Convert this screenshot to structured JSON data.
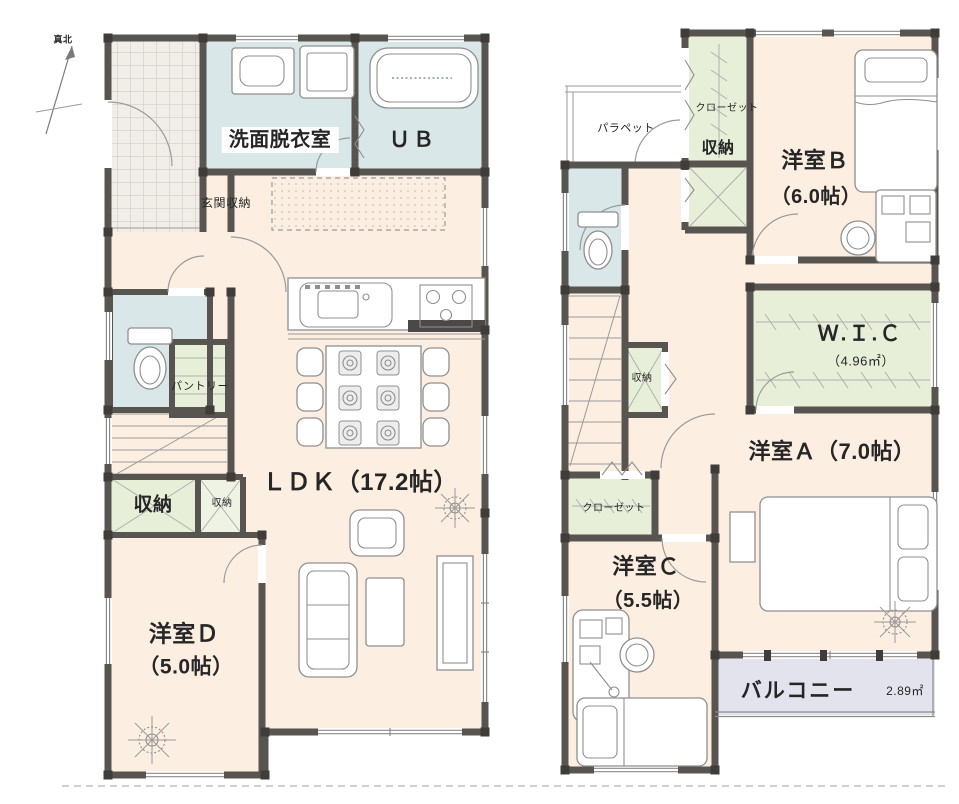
{
  "colors": {
    "wall": "#585450",
    "floor": "#fcefe1",
    "wet": "#d9e7e9",
    "storage": "#e8efd8",
    "tile_area": "#f1eee9",
    "balcony": "#e3e3ed",
    "line": "#8f8f8f"
  },
  "north": {
    "label": "真北"
  },
  "floor1": {
    "washroom": "洗面脱衣室",
    "unit_bath": "ＵＢ",
    "entrance_storage": "玄関収納",
    "pantry": "パントリー",
    "storage_large": "収納",
    "storage_small": "収納",
    "ldk": "ＬＤＫ（17.2帖）",
    "room_d": "洋室Ｄ",
    "room_d_size": "（5.0帖）"
  },
  "floor2": {
    "parapet": "パラペット",
    "closet_upper": "クローゼット",
    "storage_upper": "収納",
    "room_b": "洋室Ｂ",
    "room_b_size": "（6.0帖）",
    "storage_hall": "収納",
    "wic": "Ｗ.Ｉ.Ｃ",
    "wic_size": "（4.96㎡）",
    "room_a": "洋室Ａ（7.0帖）",
    "closet_lower": "クローゼット",
    "room_c": "洋室Ｃ",
    "room_c_size": "（5.5帖）",
    "balcony": "バルコニー",
    "balcony_area": "2.89㎡"
  }
}
